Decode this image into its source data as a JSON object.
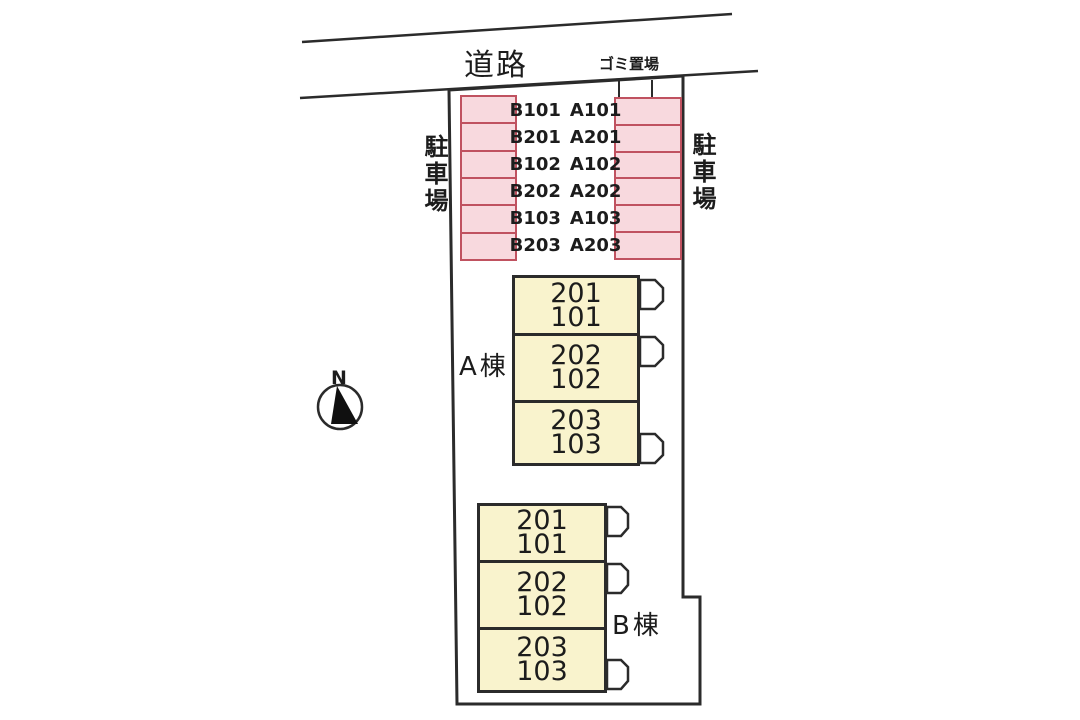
{
  "colors": {
    "line": "#2b2b2b",
    "text": "#1c1c1c",
    "parking-fill": "#f8d9de",
    "parking-border": "#c05260",
    "building-fill": "#f9f3cd",
    "background": "#ffffff"
  },
  "road": {
    "label": "道路"
  },
  "garbage": {
    "label": "ゴミ置場"
  },
  "parking": {
    "left_area_label": "駐車場",
    "right_area_label": "駐車場",
    "rows": [
      {
        "left": "B101",
        "right": "A101"
      },
      {
        "left": "B201",
        "right": "A201"
      },
      {
        "left": "B102",
        "right": "A102"
      },
      {
        "left": "B202",
        "right": "A202"
      },
      {
        "left": "B103",
        "right": "A103"
      },
      {
        "left": "B203",
        "right": "A203"
      }
    ]
  },
  "buildings": {
    "a": {
      "label": "A棟",
      "units": [
        {
          "upper": "201",
          "lower": "101"
        },
        {
          "upper": "202",
          "lower": "102"
        },
        {
          "upper": "203",
          "lower": "103"
        }
      ]
    },
    "b": {
      "label": "B棟",
      "units": [
        {
          "upper": "201",
          "lower": "101"
        },
        {
          "upper": "202",
          "lower": "102"
        },
        {
          "upper": "203",
          "lower": "103"
        }
      ]
    }
  },
  "compass": {
    "label": "N"
  }
}
